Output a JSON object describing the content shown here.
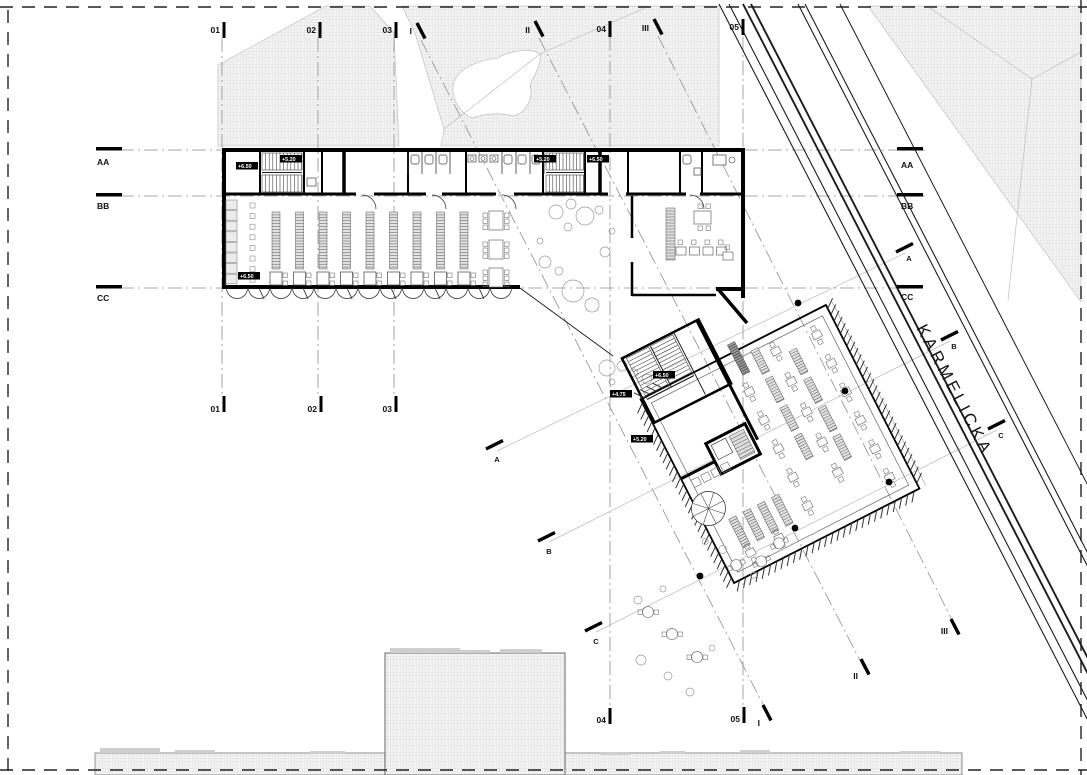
{
  "drawing": {
    "street_name": "KARMELICKA",
    "grid_columns": [
      "01",
      "02",
      "03",
      "04",
      "05"
    ],
    "grid_rows": [
      "AA",
      "BB",
      "CC"
    ],
    "grid_diagonal": [
      "I",
      "II",
      "III"
    ],
    "grid_sections": [
      "A",
      "B",
      "C"
    ],
    "levels": {
      "wing_stair_west_upper": "+6.50",
      "wing_stair_west_mid": "+5.20",
      "wing_stair_east_mid": "+5.20",
      "wing_stair_east_upper": "+6.50",
      "wing_hall": "+6.50",
      "pavilion_stair_upper": "+6.50",
      "pavilion_stair_landing": "+4.75",
      "pavilion_floor": "+5.20"
    }
  }
}
